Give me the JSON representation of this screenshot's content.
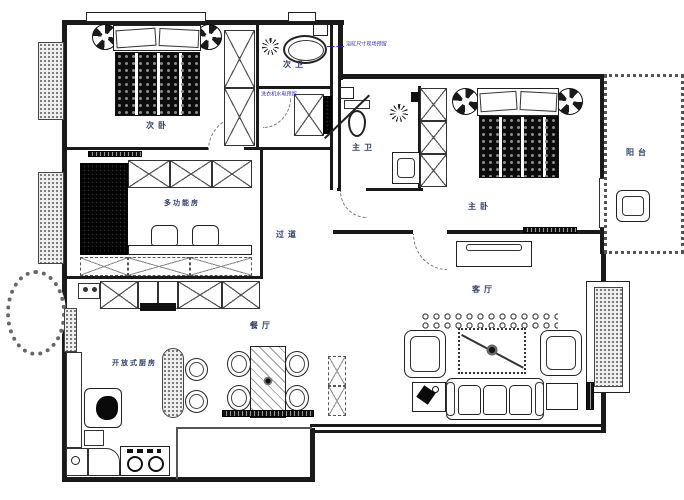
{
  "meta": {
    "drawing_type": "apartment-floor-plan"
  },
  "rooms": {
    "secondary_bedroom": "次卧",
    "secondary_bathroom": "次卫",
    "master_bathroom": "主卫",
    "master_bedroom": "主卧",
    "balcony": "阳台",
    "multifunction_room": "多功能房",
    "corridor": "过道",
    "dining_room": "餐厅",
    "living_room": "客厅",
    "open_kitchen": "开放式厨房"
  },
  "annotations": {
    "bathtub_note": "浴缸尺寸现场预留",
    "laundry_note": "洗衣机水电预留"
  },
  "colors": {
    "line": "#1a1a1a",
    "label": "#2f3f66",
    "annotation": "#3333bb",
    "paper": "#ffffff"
  }
}
